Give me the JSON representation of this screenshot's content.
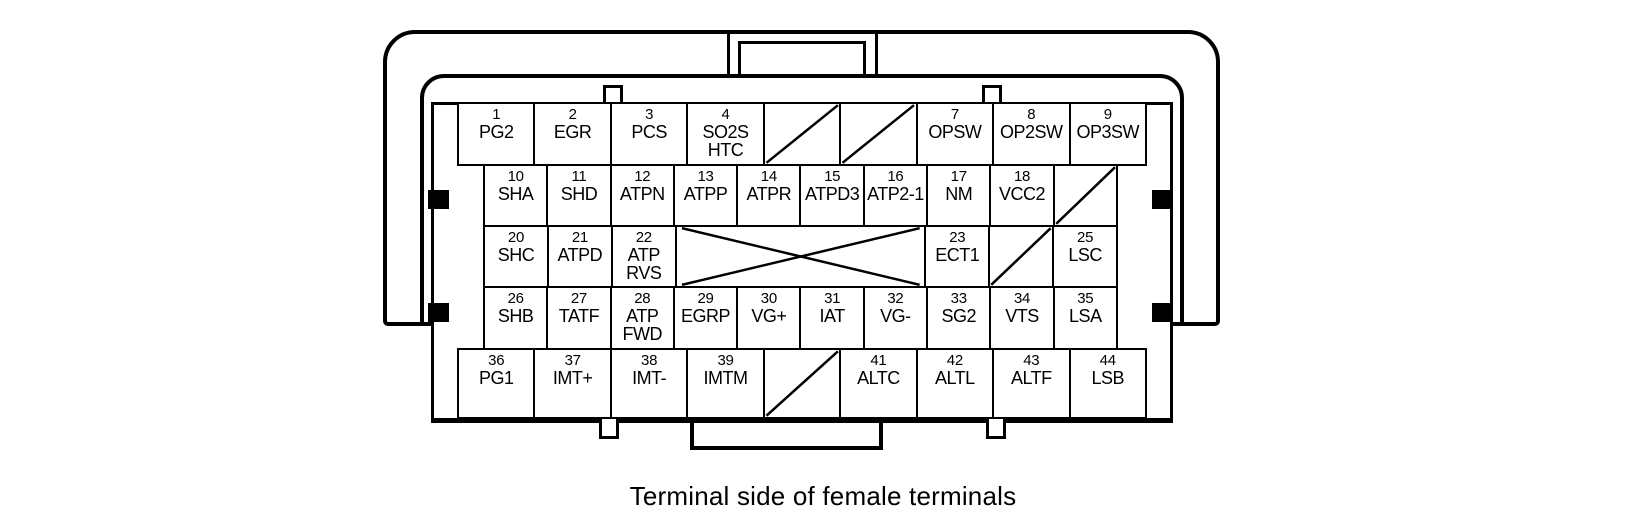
{
  "caption": "Terminal side of female terminals",
  "connector": {
    "description": "44-pin ECU connector pinout, terminal side of female terminals",
    "line_color": "#000000",
    "background_color": "#ffffff",
    "rows": [
      {
        "name": "row-1",
        "cells": [
          {
            "num": "1",
            "label": "PG2"
          },
          {
            "num": "2",
            "label": "EGR"
          },
          {
            "num": "3",
            "label": "PCS"
          },
          {
            "num": "4",
            "label": "SO2S",
            "label2": "HTC"
          },
          {
            "unused": true,
            "mark": "diagonal"
          },
          {
            "unused": true,
            "mark": "diagonal"
          },
          {
            "num": "7",
            "label": "OPSW"
          },
          {
            "num": "8",
            "label": "OP2SW"
          },
          {
            "num": "9",
            "label": "OP3SW"
          }
        ]
      },
      {
        "name": "row-2",
        "cells": [
          {
            "num": "10",
            "label": "SHA"
          },
          {
            "num": "11",
            "label": "SHD"
          },
          {
            "num": "12",
            "label": "ATPN"
          },
          {
            "num": "13",
            "label": "ATPP"
          },
          {
            "num": "14",
            "label": "ATPR"
          },
          {
            "num": "15",
            "label": "ATPD3"
          },
          {
            "num": "16",
            "label": "ATP2-1"
          },
          {
            "num": "17",
            "label": "NM"
          },
          {
            "num": "18",
            "label": "VCC2"
          },
          {
            "unused": true,
            "mark": "diagonal"
          }
        ]
      },
      {
        "name": "row-3",
        "cells": [
          {
            "num": "20",
            "label": "SHC"
          },
          {
            "num": "21",
            "label": "ATPD"
          },
          {
            "num": "22",
            "label": "ATP",
            "label2": "RVS"
          },
          {
            "unused": true,
            "mark": "cross",
            "span": 4
          },
          {
            "num": "23",
            "label": "ECT1"
          },
          {
            "unused": true,
            "mark": "diagonal"
          },
          {
            "num": "25",
            "label": "LSC"
          }
        ]
      },
      {
        "name": "row-4",
        "cells": [
          {
            "num": "26",
            "label": "SHB"
          },
          {
            "num": "27",
            "label": "TATF"
          },
          {
            "num": "28",
            "label": "ATP",
            "label2": "FWD"
          },
          {
            "num": "29",
            "label": "EGRP"
          },
          {
            "num": "30",
            "label": "VG+"
          },
          {
            "num": "31",
            "label": "IAT"
          },
          {
            "num": "32",
            "label": "VG-"
          },
          {
            "num": "33",
            "label": "SG2"
          },
          {
            "num": "34",
            "label": "VTS"
          },
          {
            "num": "35",
            "label": "LSA"
          }
        ]
      },
      {
        "name": "row-5",
        "cells": [
          {
            "num": "36",
            "label": "PG1"
          },
          {
            "num": "37",
            "label": "IMT+"
          },
          {
            "num": "38",
            "label": "IMT-"
          },
          {
            "num": "39",
            "label": "IMTM"
          },
          {
            "unused": true,
            "mark": "diagonal"
          },
          {
            "num": "41",
            "label": "ALTC"
          },
          {
            "num": "42",
            "label": "ALTL"
          },
          {
            "num": "43",
            "label": "ALTF"
          },
          {
            "num": "44",
            "label": "LSB"
          }
        ]
      }
    ]
  }
}
